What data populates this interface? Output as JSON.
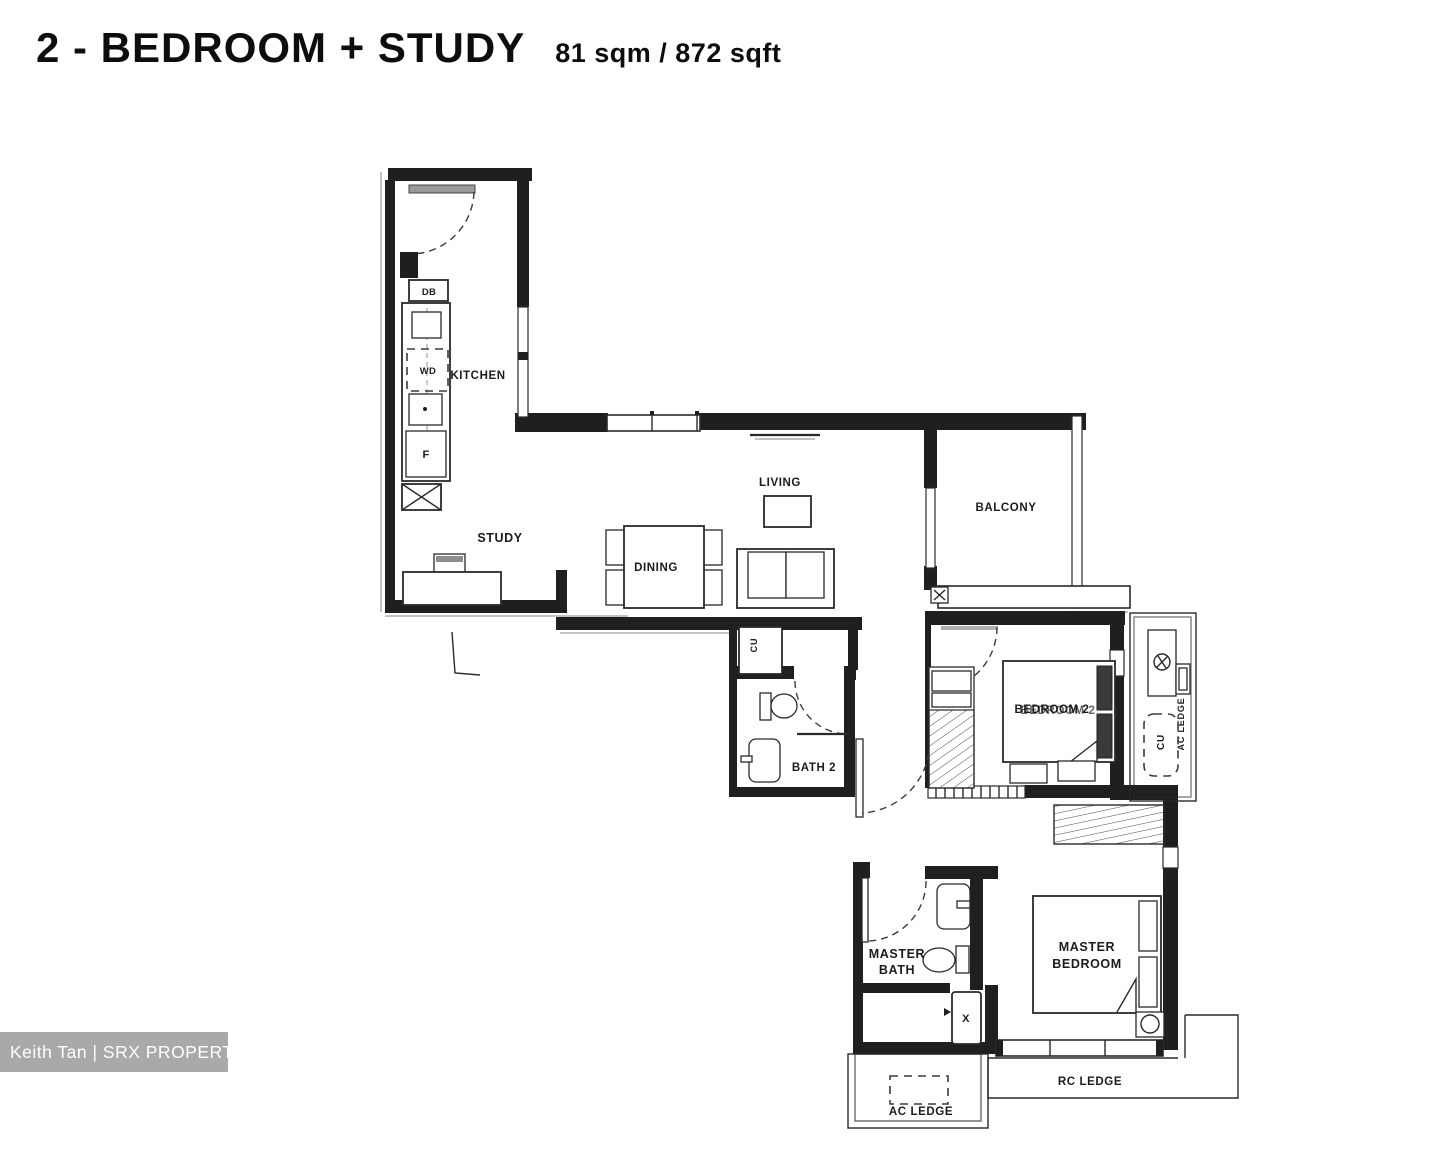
{
  "title": {
    "text": "2 - BEDROOM + STUDY",
    "area": "81 sqm / 872 sqft"
  },
  "watermark": {
    "text": "Keith Tan | SRX PROPERTY"
  },
  "labels": {
    "kitchen": "KITCHEN",
    "study": "STUDY",
    "dining": "DINING",
    "living": "LIVING",
    "balcony": "BALCONY",
    "bath2": "BATH 2",
    "bedroom2": "BEDROOM 2",
    "master_bath_1": "MASTER",
    "master_bath_2": "BATH",
    "master_bedroom_1": "MASTER",
    "master_bedroom_2": "BEDROOM",
    "rc_ledge": "RC LEDGE",
    "ac_ledge_bottom": "AC LEDGE",
    "ac_ledge_side": "AC LEDGE"
  },
  "fixtures": {
    "db": "DB",
    "wd": "WD",
    "fridge": "F",
    "water_heater": "X",
    "cu_side": "CU",
    "cu_foyer": "CU"
  },
  "colors": {
    "ink": "#1f1f1f",
    "watermark_bg": "#a9a9a9",
    "watermark_text": "#ffffff",
    "background": "#ffffff"
  }
}
